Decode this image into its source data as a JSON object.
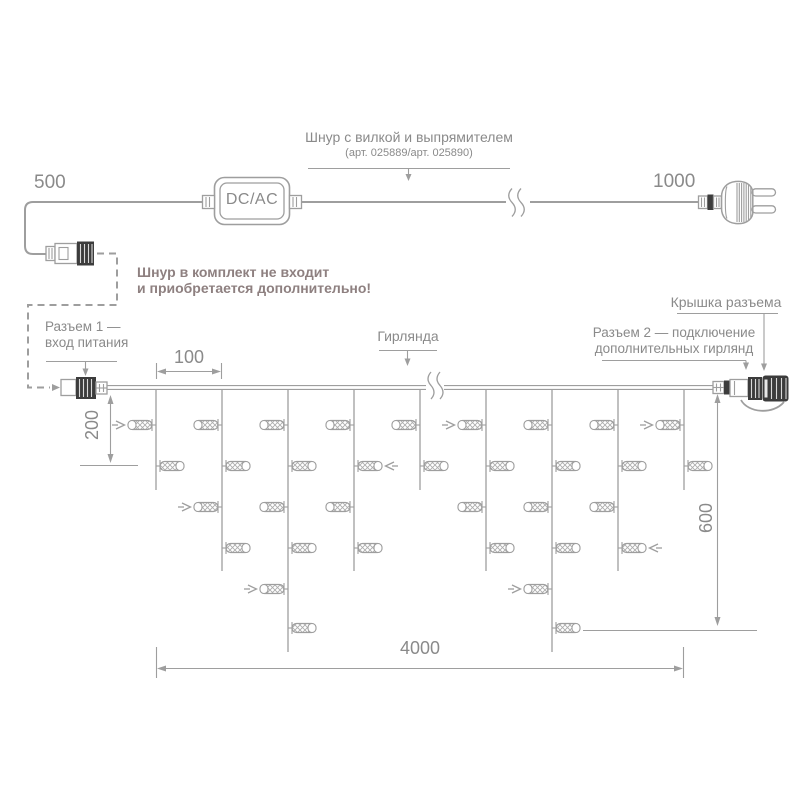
{
  "labels": {
    "len_500": "500",
    "len_1000": "1000",
    "cord_title": "Шнур с вилкой и выпрямителем",
    "cord_art": "(арт. 025889/арт. 025890)",
    "dcac": "DC/AC",
    "warning1": "Шнур в комплект не входит",
    "warning2": "и приобретается дополнительно!",
    "conn1_l1": "Разъем 1 —",
    "conn1_l2": "вход питания",
    "garland": "Гирлянда",
    "cap": "Крышка разъема",
    "conn2_l1": "Разъем 2 — подключение",
    "conn2_l2": "дополнительных гирлянд"
  },
  "dimensions": {
    "spacing": "100",
    "first_drop": "200",
    "drop_height": "600",
    "total_length": "4000"
  },
  "colors": {
    "line": "#9e9e9e",
    "text": "#8a8a8a",
    "warning": "#8e8080",
    "dark": "#3c3c3c"
  },
  "garland": {
    "strand_count": 9,
    "strand_pattern": [
      "short",
      "medium",
      "long",
      "medium",
      "short",
      "medium",
      "long",
      "medium",
      "short"
    ],
    "lights_per_strand": {
      "short": 2,
      "medium": 4,
      "long": 6
    },
    "flash_arrows": [
      {
        "strand": 1,
        "row": 1,
        "dir": "right"
      },
      {
        "strand": 2,
        "row": 3,
        "dir": "right"
      },
      {
        "strand": 3,
        "row": 5,
        "dir": "right"
      },
      {
        "strand": 4,
        "row": 2,
        "dir": "left"
      },
      {
        "strand": 6,
        "row": 1,
        "dir": "right"
      },
      {
        "strand": 7,
        "row": 5,
        "dir": "right"
      },
      {
        "strand": 8,
        "row": 4,
        "dir": "left"
      },
      {
        "strand": 9,
        "row": 1,
        "dir": "right"
      }
    ]
  }
}
